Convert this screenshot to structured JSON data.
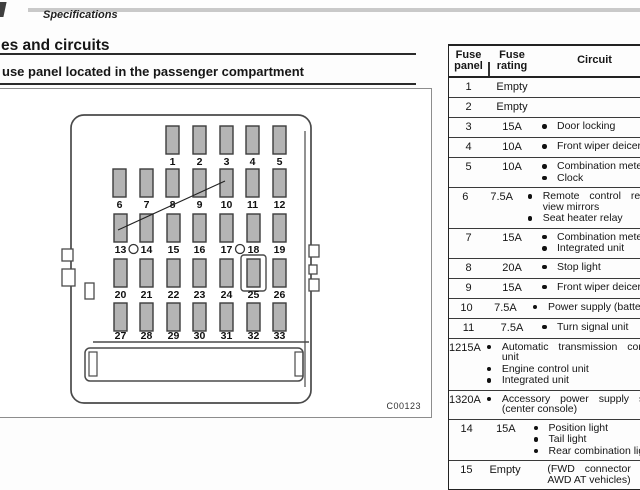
{
  "page": {
    "section_label": "Specifications",
    "heading_section": "es and circuits",
    "heading_sub": "use panel located in the passenger compartment",
    "figure_code": "C00123"
  },
  "diagram": {
    "fuse_rows": [
      [
        1,
        2,
        3,
        4,
        5
      ],
      [
        6,
        7,
        8,
        9,
        10,
        11,
        12
      ],
      [
        13,
        14,
        15,
        16,
        17,
        18,
        19
      ],
      [
        20,
        21,
        22,
        23,
        24,
        25,
        26
      ],
      [
        27,
        28,
        29,
        30,
        31,
        32,
        33
      ]
    ],
    "circle_markers_between": [
      "13-14",
      "17-18"
    ],
    "highlighted_fuse": 25,
    "pointer_from_fuse": 13,
    "pointer_to_fuse": 10
  },
  "table": {
    "headers": [
      "Fuse\npanel",
      "Fuse\nrating",
      "Circuit"
    ],
    "rows": [
      {
        "panel": "1",
        "rating": "Empty",
        "circuits": []
      },
      {
        "panel": "2",
        "rating": "Empty",
        "circuits": []
      },
      {
        "panel": "3",
        "rating": "15A",
        "circuits": [
          {
            "lines": [
              "Door locking"
            ]
          }
        ]
      },
      {
        "panel": "4",
        "rating": "10A",
        "circuits": [
          {
            "lines": [
              "Front wiper deicer"
            ]
          }
        ]
      },
      {
        "panel": "5",
        "rating": "10A",
        "circuits": [
          {
            "lines": [
              "Combination meter"
            ]
          },
          {
            "lines": [
              "Clock"
            ]
          }
        ]
      },
      {
        "panel": "6",
        "rating": "7.5A",
        "circuits": [
          {
            "lines": [
              "Remote control rear-",
              "view mirrors"
            ],
            "justify": [
              0
            ]
          },
          {
            "lines": [
              "Seat heater relay"
            ]
          }
        ]
      },
      {
        "panel": "7",
        "rating": "15A",
        "circuits": [
          {
            "lines": [
              "Combination meter"
            ]
          },
          {
            "lines": [
              "Integrated unit"
            ]
          }
        ]
      },
      {
        "panel": "8",
        "rating": "20A",
        "circuits": [
          {
            "lines": [
              "Stop light"
            ]
          }
        ]
      },
      {
        "panel": "9",
        "rating": "15A",
        "circuits": [
          {
            "lines": [
              "Front wiper deicer"
            ]
          }
        ]
      },
      {
        "panel": "10",
        "rating": "7.5A",
        "circuits": [
          {
            "lines": [
              "Power supply (battery)"
            ]
          }
        ]
      },
      {
        "panel": "11",
        "rating": "7.5A",
        "circuits": [
          {
            "lines": [
              "Turn signal unit"
            ]
          }
        ]
      },
      {
        "panel": "12",
        "rating": "15A",
        "circuits": [
          {
            "lines": [
              "Automatic transmission control",
              "unit"
            ],
            "justify": [
              0
            ]
          },
          {
            "lines": [
              "Engine control unit"
            ]
          },
          {
            "lines": [
              "Integrated unit"
            ]
          }
        ]
      },
      {
        "panel": "13",
        "rating": "20A",
        "circuits": [
          {
            "lines": [
              "Accessory power supply socket",
              "(center console)"
            ],
            "justify": [
              0
            ]
          }
        ]
      },
      {
        "panel": "14",
        "rating": "15A",
        "circuits": [
          {
            "lines": [
              "Position light"
            ]
          },
          {
            "lines": [
              "Tail light"
            ]
          },
          {
            "lines": [
              "Rear combination light"
            ]
          }
        ]
      },
      {
        "panel": "15",
        "rating": "Empty",
        "circuits": [
          {
            "lines": [
              "(FWD connector for",
              "AWD AT vehicles)"
            ],
            "justify": [
              0
            ],
            "no_bullet": true,
            "gap": true
          }
        ]
      }
    ]
  }
}
